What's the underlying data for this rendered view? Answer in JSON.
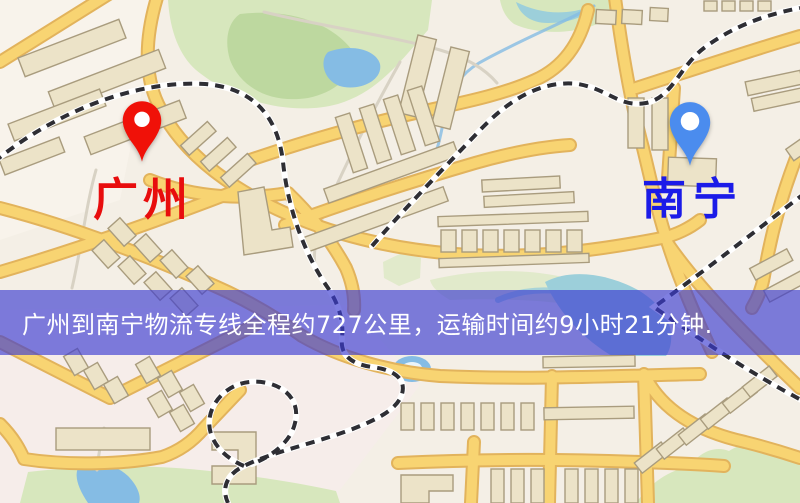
{
  "page": {
    "type": "logistics-route-map-image",
    "width": 800,
    "height": 503
  },
  "banner": {
    "text": "广州到南宁物流专线全程约727公里，运输时间约9小时21分钟."
  },
  "markers": {
    "origin": {
      "city": "广州",
      "pin_icon": "red-map-pin-icon",
      "pin_color": "#f01108",
      "label_color": "#e80d0d"
    },
    "destination": {
      "city": "南宁",
      "pin_icon": "blue-map-pin-icon",
      "pin_color": "#4b8cee",
      "label_color": "#1b1be8"
    }
  },
  "route": {
    "origin": "广州",
    "destination": "南宁",
    "distance_text": "约727公里",
    "duration_text": "约9小时21分钟"
  },
  "colors": {
    "map_bg": "#f4efe6",
    "tint_pink": "#f8ecef",
    "tint_cream": "#fdf8f1",
    "road_fill": "#f8d472",
    "road_casing": "#e2b35c",
    "park": "#d7e7bd",
    "park_dark": "#bdd89f",
    "water": "#85bce4",
    "water_teal": "#9ccfda",
    "building_fill": "#ece3c8",
    "building_stroke": "#a99c7e",
    "railway": "#2e2e34",
    "rail_base": "#ffffff",
    "minor_road": "#d8d2c4",
    "banner_bg": "rgba(59,59,209,0.65)",
    "banner_text": "#ffffff"
  }
}
